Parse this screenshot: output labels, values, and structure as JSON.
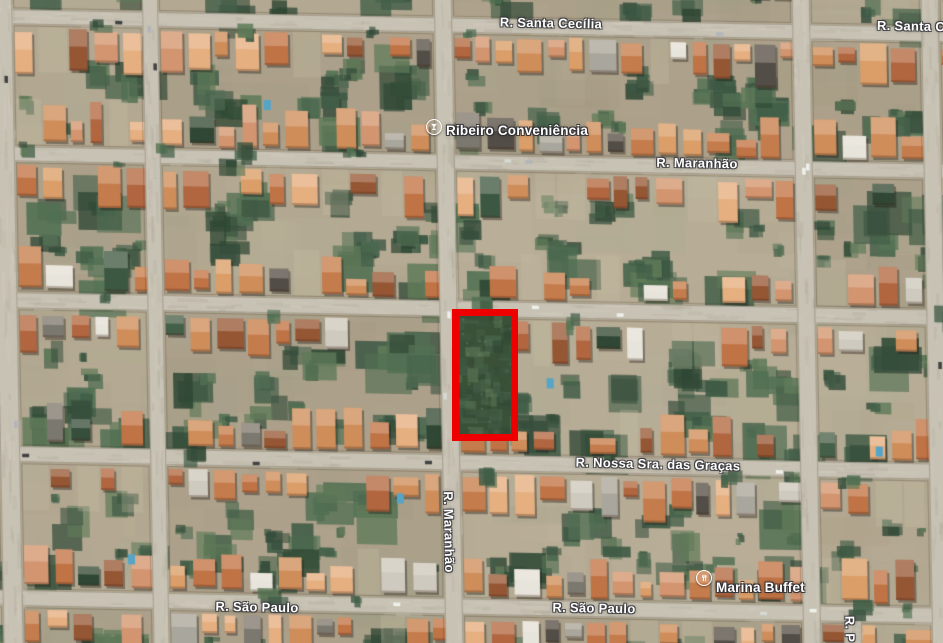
{
  "map": {
    "streets": {
      "horizontal": [
        {
          "y": 9,
          "h": 15,
          "name": "R. Santa Cecília"
        },
        {
          "y": 146,
          "h": 15,
          "name": "R. Maranhão"
        },
        {
          "y": 292,
          "h": 16
        },
        {
          "y": 446,
          "h": 16,
          "name": "R. Nossa Sra. das Graças"
        },
        {
          "y": 590,
          "h": 16,
          "name": "R. São Paulo"
        }
      ],
      "vertical": [
        {
          "x": -8,
          "w": 20
        },
        {
          "x": 142,
          "w": 16
        },
        {
          "x": 434,
          "w": 18,
          "name": "R. Maranhão"
        },
        {
          "x": 792,
          "w": 18
        },
        {
          "x": 921,
          "w": 18
        },
        {
          "x": 833,
          "w": 18,
          "y0": 598
        }
      ]
    },
    "labels": [
      {
        "text": "R. Santa Cecília"
      },
      {
        "text": "R. Santa C"
      },
      {
        "text": "R. Maranhão"
      },
      {
        "text": "R. Nossa Sra. das Graças"
      },
      {
        "text": "R. Maranhão"
      },
      {
        "text": "R. São Paulo"
      },
      {
        "text": "R. São Paulo"
      },
      {
        "text": "R. P"
      }
    ],
    "pois": [
      {
        "name": "Ribeiro Conveniência",
        "icon": "drink-icon"
      },
      {
        "name": "Marina Buffet",
        "icon": "restaurant-icon"
      }
    ],
    "highlight": {
      "x": 452,
      "y": 309,
      "width": 66,
      "height": 132,
      "border_px": 7,
      "color": "#ee0000"
    }
  },
  "palette": {
    "ground": "#b2a58d",
    "ground_light": "#c8bca3",
    "ground_dark": "#968a74",
    "street": "#c8c1b2",
    "street_light": "#ddd6c7",
    "street_edge": "#a79f8e",
    "roofs": [
      "#d08a54",
      "#dd9b63",
      "#c67845",
      "#e8ad7c",
      "#b06038",
      "#93502c",
      "#d4926b",
      "#c06e3e"
    ],
    "roof_gray": [
      "#a8a49a",
      "#cfcabf",
      "#e8e5dc",
      "#78736a"
    ],
    "veg": [
      "#3e5a42",
      "#2f4734",
      "#4b6a4c",
      "#27402c",
      "#5a7552",
      "#35523c"
    ],
    "pool": "#4fa3c7",
    "car": [
      "#f2f2ee",
      "#d8d8d4",
      "#3a3a3a",
      "#b0b4b8"
    ],
    "highlight_red": "#ee0000",
    "poi_orange": "#ef8a12",
    "label_white": "#ffffff"
  }
}
